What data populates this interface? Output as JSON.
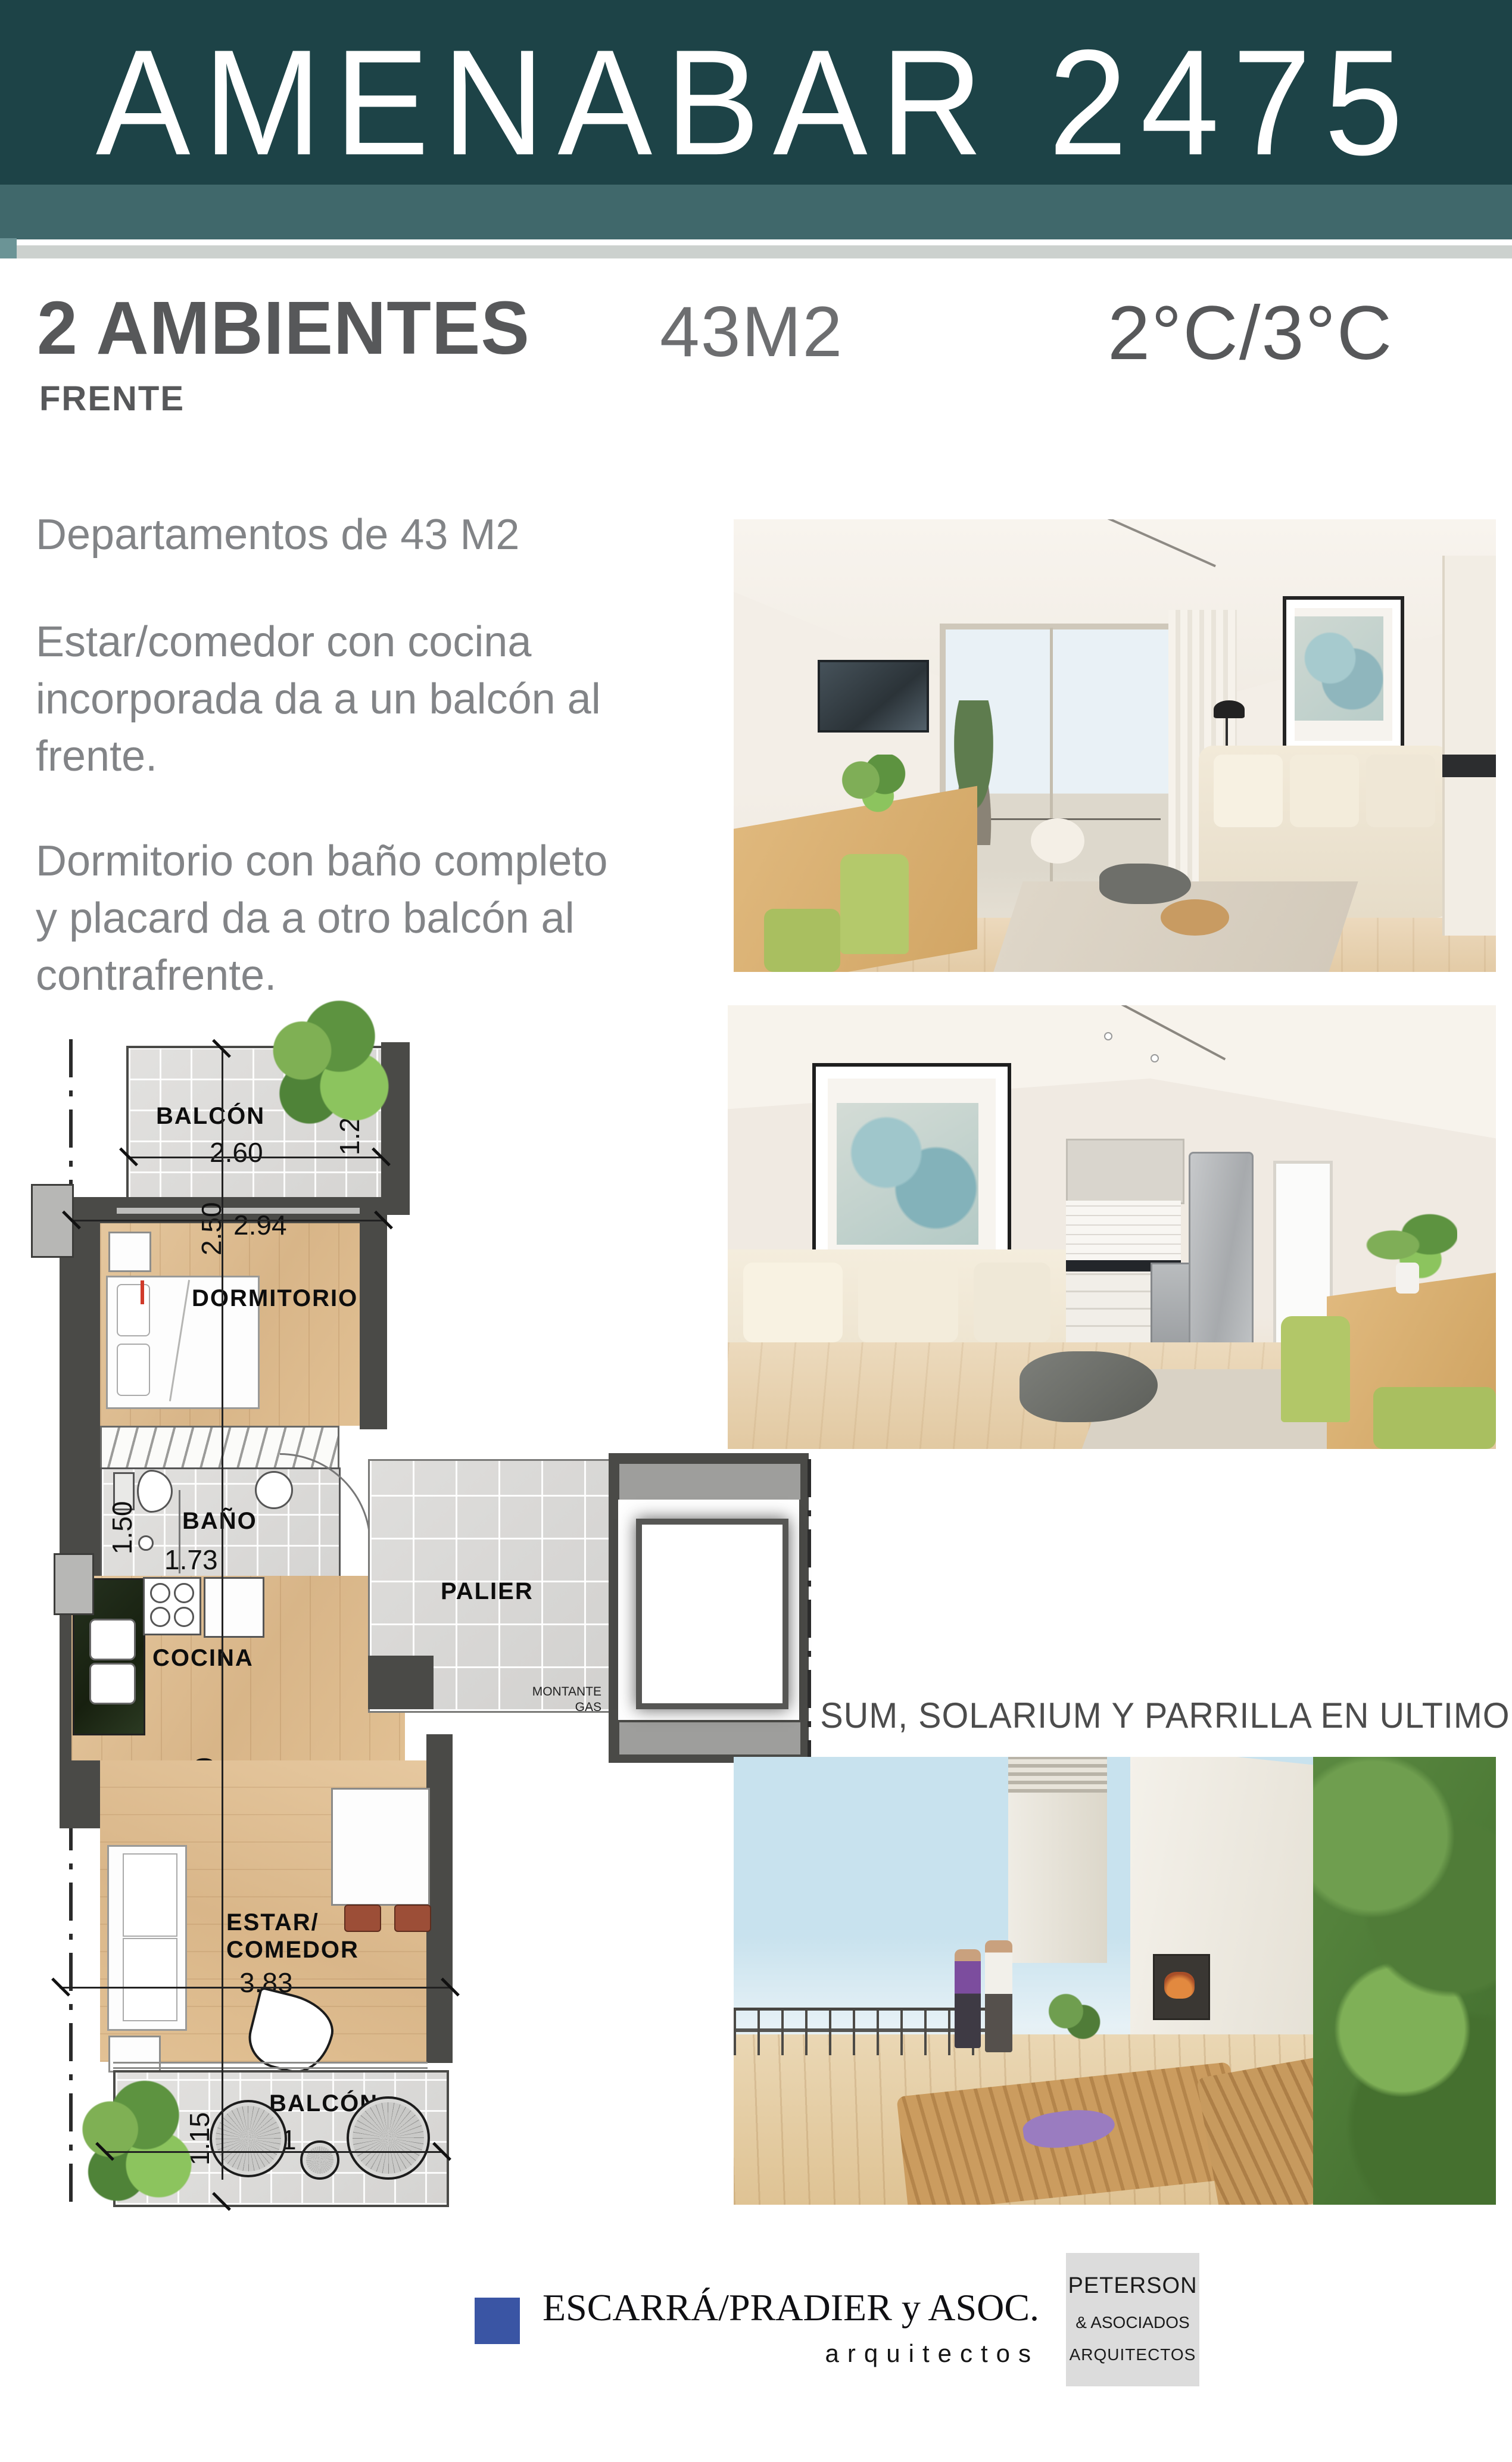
{
  "header": {
    "title": "AMENABAR 2475"
  },
  "listing": {
    "type": "2 AMBIENTES",
    "area": "43M2",
    "units": "2°C/3°C",
    "orientation": "FRENTE"
  },
  "description": {
    "p1": "Departamentos de 43 M2",
    "p2": "Estar/comedor con cocina\nincorporada da a un balcón al\nfrente.",
    "p3": "Dormitorio con baño completo\ny placard da a otro balcón al\ncontrafrente."
  },
  "plan": {
    "balcony_top": {
      "label": "BALCÓN",
      "width": "2.60",
      "depth": "1.20"
    },
    "dormitorio": {
      "label": "DORMITORIO",
      "width": "2.94",
      "depth": "2.50"
    },
    "bano": {
      "label": "BAÑO",
      "width": "1.73",
      "depth": "1.50"
    },
    "cocina": {
      "label": "COCINA"
    },
    "palier": {
      "label": "PALIER",
      "montante_line1": "MONTANTE",
      "montante_line2": "GAS"
    },
    "estar": {
      "label_line1": "ESTAR/",
      "label_line2": "COMEDOR",
      "width": "3.83",
      "length": "5.10"
    },
    "balcony_bottom": {
      "label": "BALCÓN",
      "width": "3.61",
      "depth": "1.15"
    }
  },
  "amenities": {
    "caption": "SUM, SOLARIUM Y PARRILLA EN ULTIMO PISO"
  },
  "footer": {
    "escarra": {
      "name": "ESCARRÁ/PRADIER y ASOC.",
      "subtitle": "arquitectos"
    },
    "peterson": {
      "name": "PETERSON",
      "line2": "& ASOCIADOS",
      "line3": "ARQUITECTOS"
    }
  },
  "colors": {
    "header_teal": "#1d4347",
    "header_teal_light": "#40686b",
    "strip_gray": "#ccd1ce",
    "text_dark": "#57585a",
    "text_body": "#828487",
    "accent_blue": "#3a55a4",
    "wall_dark": "#4a4a47",
    "wood": "#dcbb90",
    "art_teal": "#a4c8cc"
  }
}
